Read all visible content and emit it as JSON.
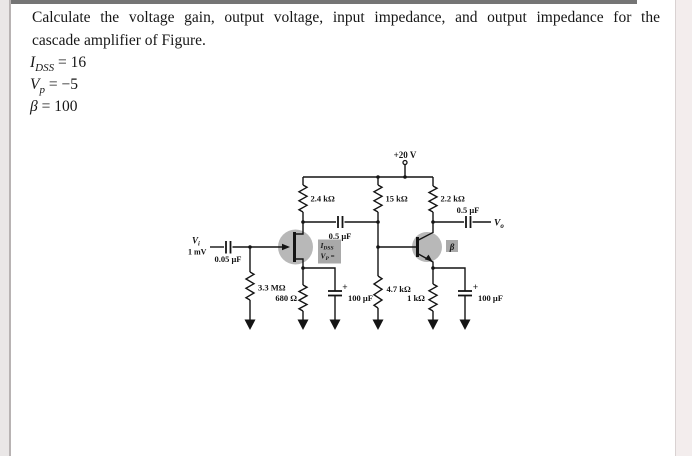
{
  "problem": {
    "statement_line1": "Calculate the voltage gain, output voltage, input impedance, and output impedance for the",
    "statement_line2": "cascade amplifier of Figure.",
    "given": {
      "idss_sym": "I",
      "idss_sub": "DSS",
      "idss_rest": " = 16",
      "vp_sym": "V",
      "vp_sub": "p",
      "vp_rest": " = −5",
      "beta_sym": "β",
      "beta_rest": " = 100"
    }
  },
  "circuit": {
    "supply": "+20 V",
    "r_drain": "2.4 kΩ",
    "r_base_upper": "15 kΩ",
    "r_collector": "2.2 kΩ",
    "c_interstage": "0.5 μF",
    "c_output": "0.5 μF",
    "c_input": "0.05 μF",
    "r_gate": "3.3 MΩ",
    "r_source": "680 Ω",
    "c_source": "100 μF",
    "r_base_lower": "4.7 kΩ",
    "r_emitter": "1 kΩ",
    "c_emitter": "100 μF",
    "v_in_sym": "V",
    "v_in_sub": "i",
    "v_in_level": "1 mV",
    "v_out_sym": "V",
    "v_out_sub": "o",
    "plus_left": "+",
    "plus_right": "+",
    "jfet_sym": "I",
    "jfet_sub": "DSS",
    "jfet_vp_sym": "V",
    "jfet_vp_sub": "P",
    "jfet_vp_rest": " =",
    "bjt_label": "β"
  },
  "colors": {
    "highlight_gray": "#b8b8b8",
    "label_box_gray": "#a9a9a9",
    "top_border_gray": "#757575",
    "ink": "#141414"
  }
}
